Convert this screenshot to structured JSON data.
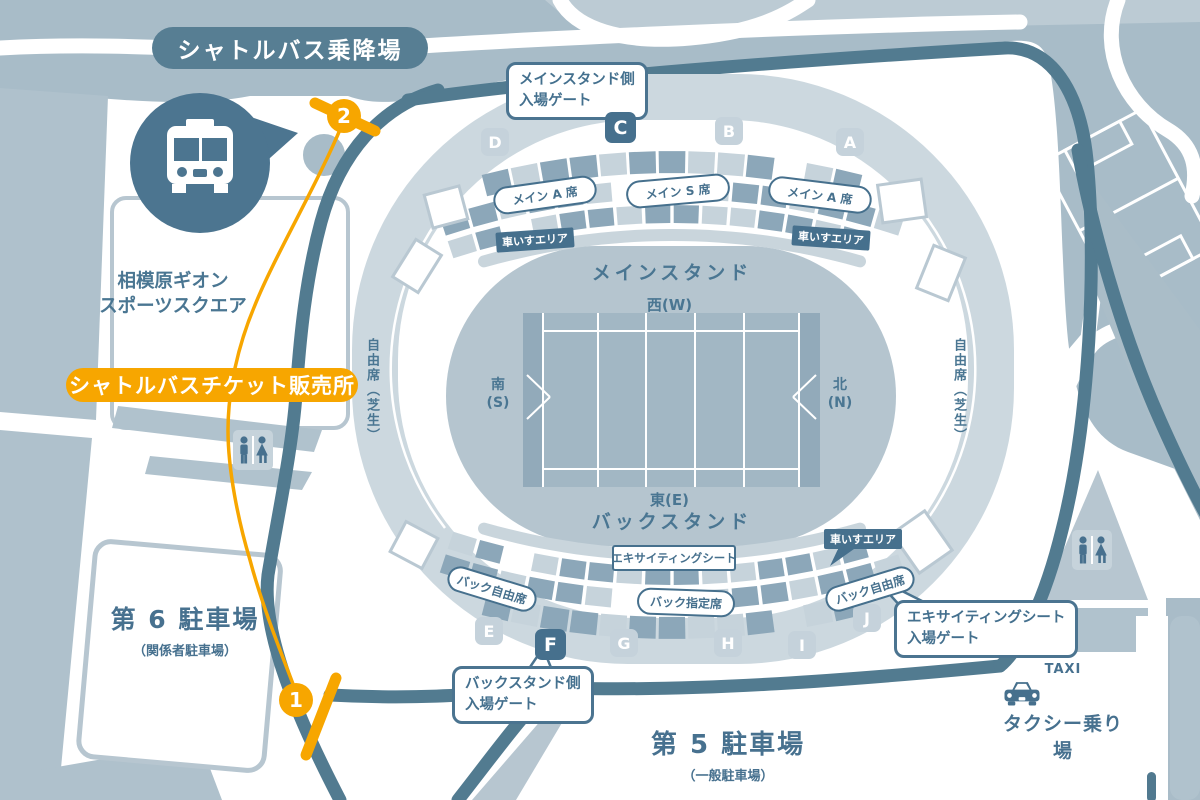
{
  "colors": {
    "orange": "#F7A600",
    "slate_text": "#47718F",
    "dark_label": "#46708D",
    "road": "#527B90"
  },
  "shuttle": {
    "stop_label": "シャトルバス乗降場",
    "ticket_office_label": "シャトルバスチケット販売所",
    "marker1": "1",
    "marker2": "2"
  },
  "sports_square": {
    "line1": "相模原ギオン",
    "line2": "スポーツスクエア"
  },
  "parking6": {
    "title": "第 6 駐車場",
    "subtitle": "（関係者駐車場）"
  },
  "parking5": {
    "title": "第 5 駐車場",
    "subtitle": "（一般駐車場）"
  },
  "taxi": {
    "sign": "TAXI",
    "label": "タクシー乗り場"
  },
  "stadium": {
    "main_stand": "メインスタンド",
    "back_stand": "バックスタンド",
    "directions": {
      "west": "西(W)",
      "east": "東(E)",
      "south_top": "南",
      "south_bottom": "(S)",
      "north_top": "北",
      "north_bottom": "(N)"
    },
    "lawn_seat": "自由席（芝生）",
    "seats": {
      "main_a_left": "メイン A 席",
      "main_s": "メイン S 席",
      "main_a_right": "メイン A 席",
      "back_free_left": "バック自由席",
      "back_free_right": "バック自由席",
      "back_reserved": "バック指定席",
      "exciting": "エキサイティングシート"
    },
    "wheelchair_labels": [
      "車いすエリア",
      "車いすエリア",
      "車いすエリア"
    ],
    "gates": [
      {
        "label": "D",
        "highlight": false
      },
      {
        "label": "C",
        "highlight": true
      },
      {
        "label": "B",
        "highlight": false
      },
      {
        "label": "A",
        "highlight": false
      },
      {
        "label": "E",
        "highlight": false
      },
      {
        "label": "F",
        "highlight": true
      },
      {
        "label": "G",
        "highlight": false
      },
      {
        "label": "H",
        "highlight": false
      },
      {
        "label": "I",
        "highlight": false
      },
      {
        "label": "J",
        "highlight": false
      }
    ],
    "bubbles": {
      "main_gate": {
        "line1": "メインスタンド側",
        "line2": "入場ゲート"
      },
      "back_gate": {
        "line1": "バックスタンド側",
        "line2": "入場ゲート"
      },
      "exciting_gate": {
        "line1": "エキサイティングシート",
        "line2": "入場ゲート"
      }
    }
  }
}
